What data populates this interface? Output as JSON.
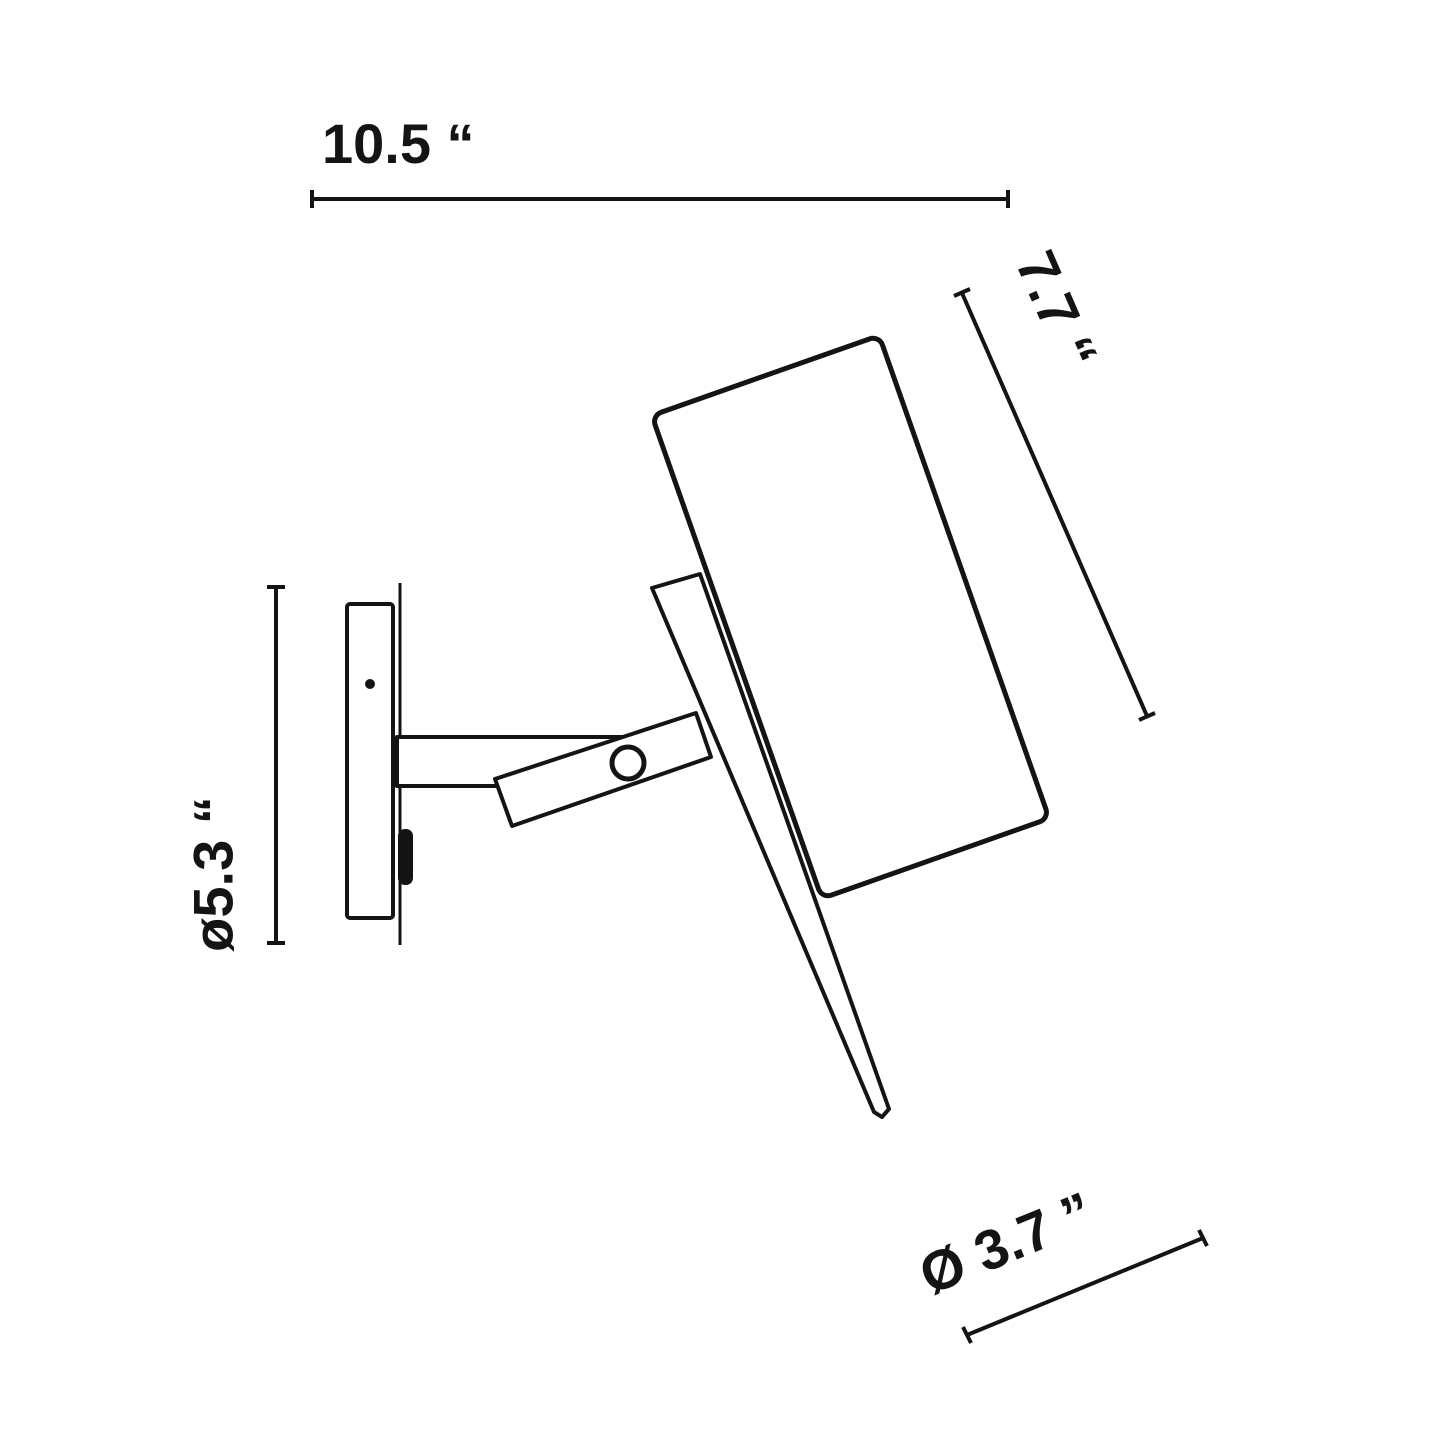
{
  "diagram": {
    "type": "technical dimension drawing",
    "subject": "wall-mounted adjustable spotlight, side elevation",
    "background_color": "#ffffff",
    "line_color": "#141414"
  },
  "dims": {
    "top": {
      "label": "10.5 “",
      "value": 10.5,
      "orientation": "horizontal"
    },
    "right": {
      "label": "7.7 “",
      "value": 7.7,
      "orientation": "diagonal-along-shade"
    },
    "left": {
      "label": "ø5.3 “",
      "value": 5.3,
      "orientation": "vertical"
    },
    "bottom": {
      "label": "Ø 3.7 ”",
      "value": 3.7,
      "orientation": "diagonal"
    }
  }
}
